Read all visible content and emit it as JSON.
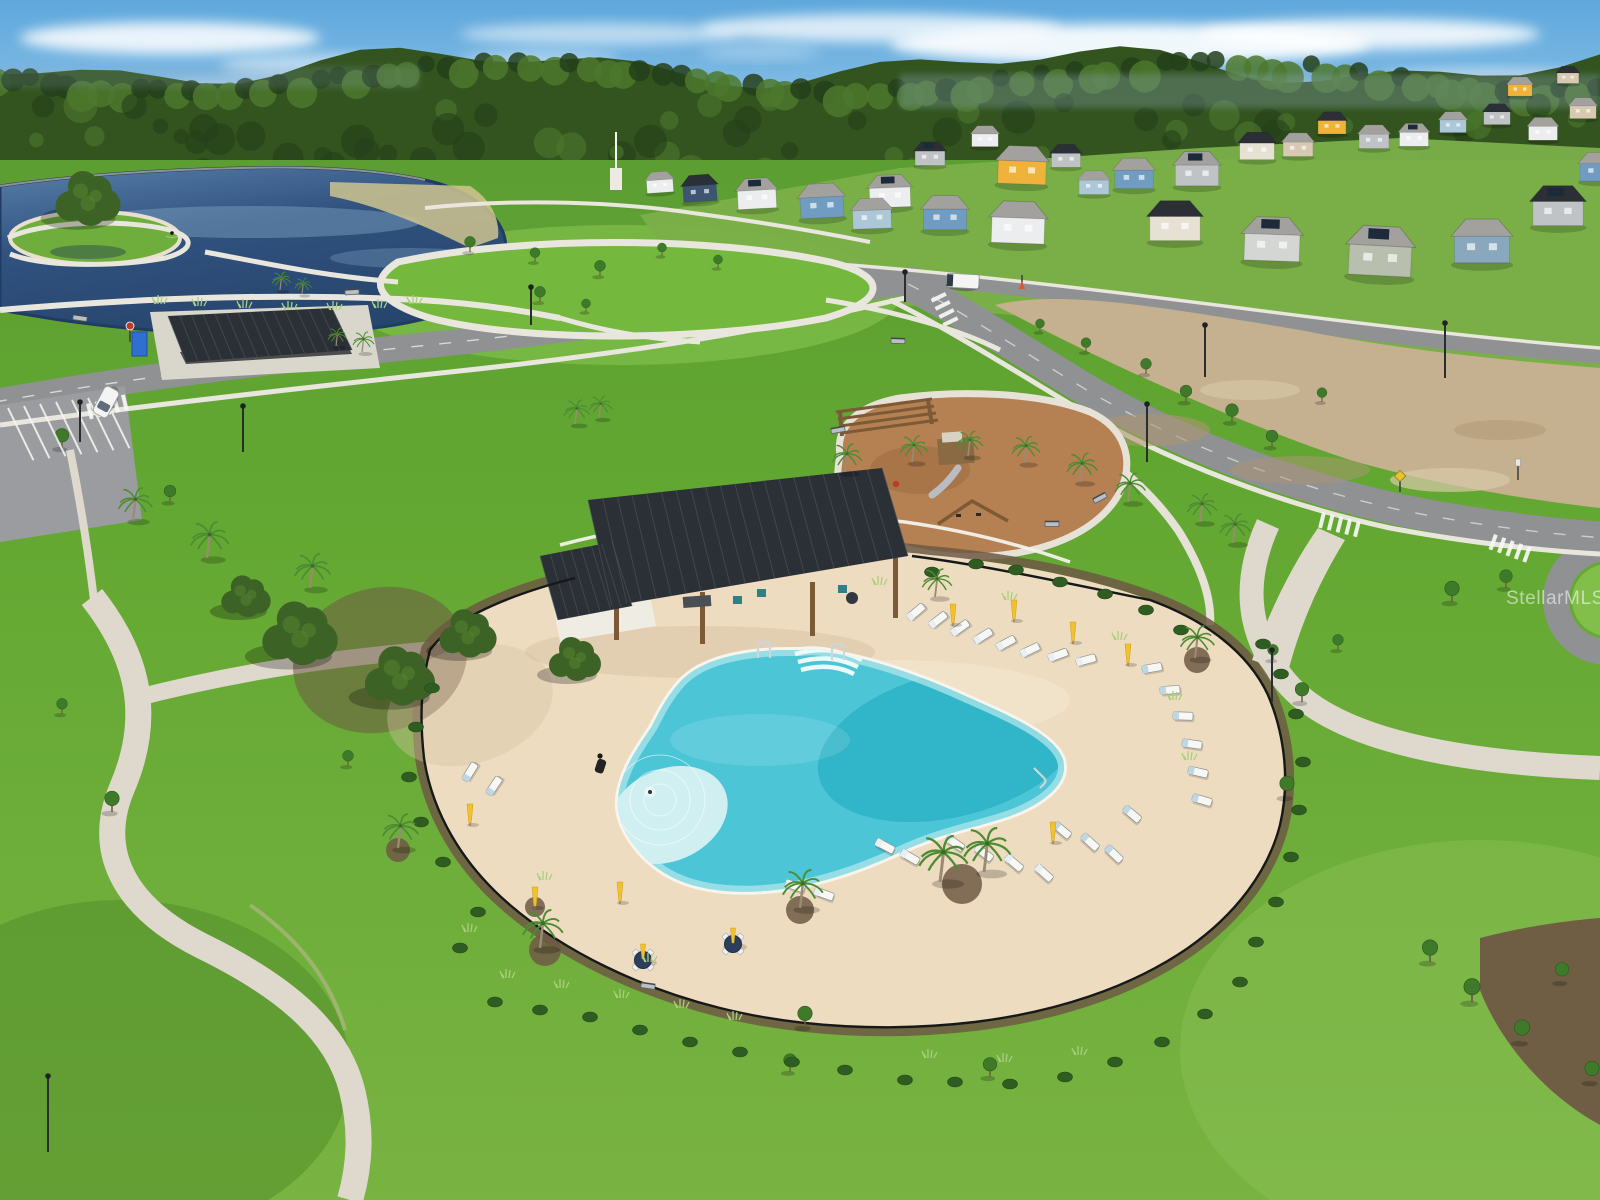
{
  "meta": {
    "type": "aerial-real-estate-photo",
    "subject": "Aerial view of a community amenity center: freeform resort pool with cabana, playground, lakeside park, trails and new-construction homes"
  },
  "watermark": {
    "text": "StellarMLS"
  },
  "palette": {
    "skyTop": "#5fa8dc",
    "skyHorizon": "#bcdcf2",
    "cloud": "#ffffff",
    "forestDark": "#24401b",
    "forest": "#33541f",
    "forestLight": "#4c782d",
    "haze": "#8fa9bd",
    "lakeDeep": "#203c62",
    "lake": "#31527f",
    "lakeLight": "#587fa9",
    "lakeSheen": "#7fa3c4",
    "grass": "#63a832",
    "grassLight": "#82bf4a",
    "grassDark": "#4c8826",
    "grassPale": "#8ec45a",
    "grassStrip": "#5d9e33",
    "path": "#e9e6dd",
    "walk": "#ded9cc",
    "walkStain": "#c9b9a0",
    "road": "#8f9193",
    "roadDark": "#7a7c7f",
    "marking": "#f7f7f2",
    "parking": "#9a9c9f",
    "dirt": "#c5b190",
    "dirtDark": "#ad9672",
    "dirtLight": "#d9c9a9",
    "deck": "#eddcc0",
    "deckLight": "#f5e9d2",
    "deckShadow": "#d8c3a2",
    "poolEdge": "#a9e4e8",
    "pool": "#4cc5d7",
    "poolDeep": "#2db1c7",
    "poolBeach": "#cfeff1",
    "poolStep": "#ecfafa",
    "coping": "#f8f5ee",
    "roofDark": "#2b2f36",
    "roofSeam": "#4a515c",
    "wood": "#7d5a36",
    "mulchPlay": "#b58052",
    "mulch": "#6f5944",
    "shrub": "#2f5c21",
    "shrubLight": "#47802c",
    "tuft": "#a9cf7c",
    "canopy": "#3c6325",
    "canopyLight": "#55832f",
    "palmGreen": "#4e8c33",
    "palmTrunk": "#9b8a74",
    "fence": "#17181a",
    "fenceWhite": "#f2f1ea",
    "umbrella": "#f2c12e",
    "tableNavy": "#2c3e5e",
    "chair": "#f7f7f4",
    "cushion": "#bed8e3",
    "houseWhite": "#ecedee",
    "houseGray": "#c0c3c6",
    "houseBlue": "#6f9cc0",
    "houseLightBlue": "#abc7d8",
    "houseSlate": "#8aa8bd",
    "houseNavy": "#3d5570",
    "houseCream": "#e7e1d3",
    "houseTan": "#d8c9b2",
    "houseSage": "#b9bfae",
    "houseYellow": "#efb33c",
    "houseLtGray": "#d3d6d2",
    "roofGray": "#a2a19e",
    "roofMid": "#8c8b88",
    "solar": "#1d2a3a",
    "chrome": "#cfd6da",
    "sand": "#e8e0cc",
    "vehicle": "#f4f4f2",
    "red": "#c0392b",
    "signYellow": "#e9c32a",
    "porta": "#2f6fd0"
  },
  "scene": {
    "clouds": [
      [
        170,
        38,
        150,
        16,
        0.85
      ],
      [
        330,
        66,
        110,
        12,
        0.5
      ],
      [
        600,
        34,
        140,
        11,
        0.55
      ],
      [
        540,
        60,
        80,
        9,
        0.4
      ],
      [
        880,
        28,
        180,
        14,
        0.75
      ],
      [
        1130,
        44,
        240,
        20,
        0.9
      ],
      [
        1370,
        34,
        170,
        15,
        0.85
      ],
      [
        1490,
        78,
        110,
        9,
        0.5
      ],
      [
        1040,
        78,
        140,
        9,
        0.4
      ],
      [
        760,
        52,
        60,
        7,
        0.3
      ],
      [
        240,
        86,
        90,
        8,
        0.35
      ],
      [
        1240,
        90,
        120,
        8,
        0.3
      ]
    ],
    "houses": [
      [
        660,
        186,
        0.55,
        -4,
        "houseWhite",
        "roofGray",
        0
      ],
      [
        700,
        193,
        0.7,
        -4,
        "houseNavy",
        "roofDark",
        0
      ],
      [
        757,
        199,
        0.8,
        -3,
        "houseWhite",
        "roofGray",
        1
      ],
      [
        822,
        207,
        0.9,
        -3,
        "houseBlue",
        "roofGray",
        0
      ],
      [
        890,
        197,
        0.85,
        -2,
        "houseWhite",
        "roofGray",
        1
      ],
      [
        930,
        158,
        0.62,
        0,
        "houseGray",
        "roofDark",
        1
      ],
      [
        985,
        140,
        0.55,
        0,
        "houseWhite",
        "roofGray",
        0
      ],
      [
        1022,
        172,
        1.0,
        2,
        "houseYellow",
        "roofGray",
        0
      ],
      [
        1066,
        160,
        0.6,
        0,
        "houseGray",
        "roofDark",
        0
      ],
      [
        1094,
        187,
        0.62,
        0,
        "houseLightBlue",
        "roofGray",
        0
      ],
      [
        1134,
        179,
        0.8,
        0,
        "houseBlue",
        "roofGray",
        0
      ],
      [
        1197,
        175,
        0.9,
        0,
        "houseGray",
        "roofGray",
        1
      ],
      [
        1257,
        151,
        0.72,
        0,
        "houseCream",
        "roofDark",
        0
      ],
      [
        1298,
        149,
        0.62,
        0,
        "houseTan",
        "roofGray",
        0
      ],
      [
        1332,
        127,
        0.58,
        0,
        "houseYellow",
        "roofDark",
        0
      ],
      [
        1374,
        141,
        0.62,
        0,
        "houseGray",
        "roofGray",
        0
      ],
      [
        1414,
        139,
        0.6,
        0,
        "houseWhite",
        "roofGray",
        1
      ],
      [
        1453,
        126,
        0.55,
        0,
        "houseLightBlue",
        "roofGray",
        0
      ],
      [
        1497,
        118,
        0.55,
        0,
        "houseGray",
        "roofDark",
        0
      ],
      [
        1543,
        133,
        0.6,
        0,
        "houseWhite",
        "roofGray",
        0
      ],
      [
        1583,
        112,
        0.55,
        0,
        "houseTan",
        "roofGray",
        0
      ],
      [
        1520,
        90,
        0.5,
        0,
        "houseYellow",
        "roofGray",
        0
      ],
      [
        1568,
        78,
        0.45,
        0,
        "houseTan",
        "roofDark",
        0
      ],
      [
        872,
        219,
        0.8,
        -2,
        "houseLightBlue",
        "roofGray",
        0
      ],
      [
        945,
        219,
        0.9,
        0,
        "houseBlue",
        "roofGray",
        0
      ],
      [
        1018,
        230,
        1.1,
        2,
        "houseWhite",
        "roofGray",
        0
      ],
      [
        1175,
        228,
        1.05,
        0,
        "houseCream",
        "roofDark",
        0
      ],
      [
        1272,
        247,
        1.15,
        2,
        "houseLtGray",
        "roofGray",
        1
      ],
      [
        1380,
        260,
        1.3,
        3,
        "houseSage",
        "roofGray",
        1
      ],
      [
        1482,
        249,
        1.15,
        0,
        "houseSlate",
        "roofGray",
        0
      ],
      [
        1558,
        213,
        1.05,
        0,
        "houseGray",
        "roofDark",
        1
      ],
      [
        1598,
        172,
        0.75,
        0,
        "houseBlue",
        "roofGray",
        0
      ]
    ],
    "palms": [
      [
        133,
        520,
        0.8
      ],
      [
        207,
        558,
        0.9
      ],
      [
        310,
        588,
        0.85
      ],
      [
        362,
        352,
        0.5
      ],
      [
        336,
        346,
        0.45
      ],
      [
        575,
        424,
        0.6
      ],
      [
        599,
        418,
        0.55
      ],
      [
        280,
        290,
        0.45
      ],
      [
        302,
        294,
        0.4
      ],
      [
        845,
        472,
        0.7
      ],
      [
        912,
        462,
        0.65
      ],
      [
        968,
        456,
        0.62
      ],
      [
        1024,
        463,
        0.66
      ],
      [
        1080,
        482,
        0.72
      ],
      [
        1128,
        502,
        0.72
      ],
      [
        1200,
        522,
        0.7
      ],
      [
        1233,
        543,
        0.72
      ],
      [
        1195,
        658,
        0.8
      ],
      [
        935,
        597,
        0.7
      ],
      [
        940,
        882,
        1.15
      ],
      [
        984,
        872,
        1.1
      ],
      [
        800,
        908,
        0.95
      ],
      [
        540,
        948,
        0.95
      ],
      [
        398,
        848,
        0.85
      ]
    ],
    "beds": [
      [
        545,
        950,
        16
      ],
      [
        800,
        910,
        14
      ],
      [
        962,
        884,
        20
      ],
      [
        398,
        850,
        12
      ],
      [
        1197,
        660,
        13
      ],
      [
        535,
        907,
        10
      ]
    ],
    "oaks": [
      [
        88,
        206,
        1.25
      ],
      [
        300,
        642,
        1.45
      ],
      [
        400,
        684,
        1.35
      ],
      [
        468,
        640,
        1.1
      ],
      [
        246,
        602,
        0.95
      ],
      [
        575,
        665,
        1.0
      ]
    ],
    "trees": [
      [
        62,
        448,
        0.75
      ],
      [
        170,
        502,
        0.65
      ],
      [
        470,
        252,
        0.6
      ],
      [
        535,
        262,
        0.55
      ],
      [
        600,
        276,
        0.6
      ],
      [
        662,
        256,
        0.5
      ],
      [
        718,
        268,
        0.5
      ],
      [
        540,
        302,
        0.6
      ],
      [
        586,
        312,
        0.5
      ],
      [
        1040,
        332,
        0.5
      ],
      [
        1086,
        352,
        0.55
      ],
      [
        1146,
        374,
        0.6
      ],
      [
        1186,
        402,
        0.65
      ],
      [
        1232,
        422,
        0.7
      ],
      [
        1272,
        447,
        0.65
      ],
      [
        1322,
        402,
        0.55
      ],
      [
        1452,
        602,
        0.8
      ],
      [
        1506,
        588,
        0.7
      ],
      [
        1430,
        962,
        0.85
      ],
      [
        1472,
        1002,
        0.9
      ],
      [
        1522,
        1042,
        0.85
      ],
      [
        1562,
        982,
        0.75
      ],
      [
        1592,
        1082,
        0.8
      ],
      [
        805,
        1027,
        0.8
      ],
      [
        990,
        1077,
        0.75
      ],
      [
        790,
        1072,
        0.7
      ],
      [
        1287,
        797,
        0.8
      ],
      [
        1302,
        702,
        0.75
      ],
      [
        1273,
        660,
        0.6
      ],
      [
        1338,
        650,
        0.6
      ],
      [
        112,
        812,
        0.8
      ],
      [
        62,
        714,
        0.6
      ],
      [
        348,
        766,
        0.6
      ]
    ],
    "shrubs": [
      [
        495,
        1002
      ],
      [
        540,
        1010
      ],
      [
        590,
        1017
      ],
      [
        640,
        1030
      ],
      [
        690,
        1042
      ],
      [
        740,
        1052
      ],
      [
        792,
        1062
      ],
      [
        845,
        1070
      ],
      [
        905,
        1080
      ],
      [
        955,
        1082
      ],
      [
        1010,
        1084
      ],
      [
        1065,
        1077
      ],
      [
        1115,
        1062
      ],
      [
        1162,
        1042
      ],
      [
        1205,
        1014
      ],
      [
        1240,
        982
      ],
      [
        1256,
        942
      ],
      [
        1276,
        902
      ],
      [
        1291,
        857
      ],
      [
        1299,
        810
      ],
      [
        1303,
        762
      ],
      [
        1296,
        714
      ],
      [
        1281,
        674
      ],
      [
        1263,
        644
      ],
      [
        932,
        572
      ],
      [
        976,
        564
      ],
      [
        1016,
        570
      ],
      [
        1060,
        582
      ],
      [
        1105,
        594
      ],
      [
        1146,
        610
      ],
      [
        1181,
        630
      ],
      [
        443,
        862
      ],
      [
        421,
        822
      ],
      [
        409,
        777
      ],
      [
        416,
        727
      ],
      [
        432,
        688
      ],
      [
        460,
        948
      ],
      [
        478,
        912
      ]
    ],
    "tufts": [
      [
        508,
        978
      ],
      [
        562,
        988
      ],
      [
        622,
        998
      ],
      [
        682,
        1008
      ],
      [
        735,
        1020
      ],
      [
        470,
        932
      ],
      [
        650,
        962
      ],
      [
        930,
        1058
      ],
      [
        1005,
        1062
      ],
      [
        1080,
        1055
      ],
      [
        545,
        880
      ],
      [
        880,
        585
      ],
      [
        1010,
        600
      ],
      [
        1120,
        640
      ],
      [
        1175,
        700
      ],
      [
        1190,
        760
      ],
      [
        160,
        304
      ],
      [
        200,
        306
      ],
      [
        245,
        308
      ],
      [
        290,
        310
      ],
      [
        335,
        310
      ],
      [
        380,
        308
      ],
      [
        415,
        304
      ]
    ],
    "loungers": [
      [
        916,
        612,
        -40,
        0
      ],
      [
        938,
        620,
        -38,
        0
      ],
      [
        960,
        628,
        -35,
        0
      ],
      [
        983,
        636,
        -32,
        0
      ],
      [
        1006,
        643,
        -28,
        0
      ],
      [
        1030,
        650,
        -25,
        0
      ],
      [
        1058,
        655,
        -20,
        0
      ],
      [
        1086,
        660,
        -15,
        0
      ],
      [
        1152,
        668,
        -10,
        1
      ],
      [
        1170,
        690,
        -4,
        1
      ],
      [
        1183,
        716,
        2,
        1
      ],
      [
        1192,
        744,
        8,
        1
      ],
      [
        1198,
        772,
        13,
        1
      ],
      [
        1202,
        800,
        16,
        1
      ],
      [
        955,
        843,
        35,
        0
      ],
      [
        984,
        853,
        38,
        0
      ],
      [
        1014,
        863,
        40,
        0
      ],
      [
        1044,
        873,
        42,
        0
      ],
      [
        1062,
        830,
        40,
        1
      ],
      [
        1090,
        842,
        42,
        1
      ],
      [
        1114,
        854,
        44,
        1
      ],
      [
        1132,
        814,
        40,
        1
      ],
      [
        885,
        846,
        28,
        0
      ],
      [
        910,
        857,
        30,
        0
      ],
      [
        795,
        886,
        18,
        0
      ],
      [
        824,
        894,
        20,
        0
      ],
      [
        470,
        772,
        -58,
        1
      ],
      [
        494,
        786,
        -56,
        1
      ]
    ],
    "umbrellas": [
      [
        953,
        624
      ],
      [
        1014,
        620
      ],
      [
        1073,
        642
      ],
      [
        1128,
        664
      ],
      [
        1053,
        842
      ],
      [
        620,
        902
      ],
      [
        535,
        907
      ],
      [
        470,
        824
      ]
    ],
    "tables": [
      [
        643,
        960
      ],
      [
        733,
        944
      ]
    ],
    "benches": [
      [
        352,
        292,
        -4
      ],
      [
        80,
        318,
        8
      ],
      [
        898,
        341,
        2
      ],
      [
        1100,
        498,
        -28
      ],
      [
        648,
        986,
        8
      ],
      [
        1052,
        524,
        0
      ],
      [
        838,
        430,
        -10
      ]
    ],
    "lamps": [
      [
        243,
        452,
        46
      ],
      [
        80,
        442,
        40
      ],
      [
        531,
        325,
        38
      ],
      [
        1147,
        462,
        58
      ],
      [
        1205,
        377,
        52
      ],
      [
        48,
        1152,
        76
      ],
      [
        1272,
        702,
        52
      ],
      [
        905,
        302,
        30
      ],
      [
        1445,
        378,
        55
      ]
    ],
    "signs": [
      [
        130,
        342,
        "stop"
      ],
      [
        1400,
        492,
        "ped"
      ],
      [
        1518,
        480,
        "white"
      ],
      [
        1022,
        289,
        "cone"
      ]
    ],
    "crosswalks": [
      [
        222,
        356,
        -8,
        6
      ],
      [
        86,
        404,
        -14,
        5
      ],
      [
        945,
        292,
        64,
        4
      ],
      [
        1322,
        512,
        14,
        5
      ],
      [
        1494,
        534,
        20,
        5
      ]
    ],
    "parkingStripes": {
      "x0": 8,
      "y0": 408,
      "n": 7,
      "dx": 16,
      "dy": -2,
      "len": 58,
      "rot": -64
    },
    "vehicles": {
      "car": [
        106,
        402,
        -62
      ],
      "van": [
        963,
        281,
        3
      ]
    },
    "roofSeams": [
      {
        "a": [
          588,
          500
        ],
        "b": [
          882,
          468
        ],
        "d": [
          612,
          606
        ],
        "c": [
          908,
          556
        ],
        "n": 20
      },
      {
        "a": [
          168,
          316
        ],
        "b": [
          332,
          308
        ],
        "d": [
          186,
          362
        ],
        "c": [
          352,
          350
        ],
        "n": 14
      },
      {
        "a": [
          540,
          556
        ],
        "b": [
          612,
          542
        ],
        "d": [
          558,
          620
        ],
        "c": [
          632,
          606
        ],
        "n": 7
      }
    ],
    "people": {
      "adult": [
        600,
        758
      ],
      "child": [
        650,
        792
      ]
    },
    "bird": [
      172,
      233
    ]
  }
}
